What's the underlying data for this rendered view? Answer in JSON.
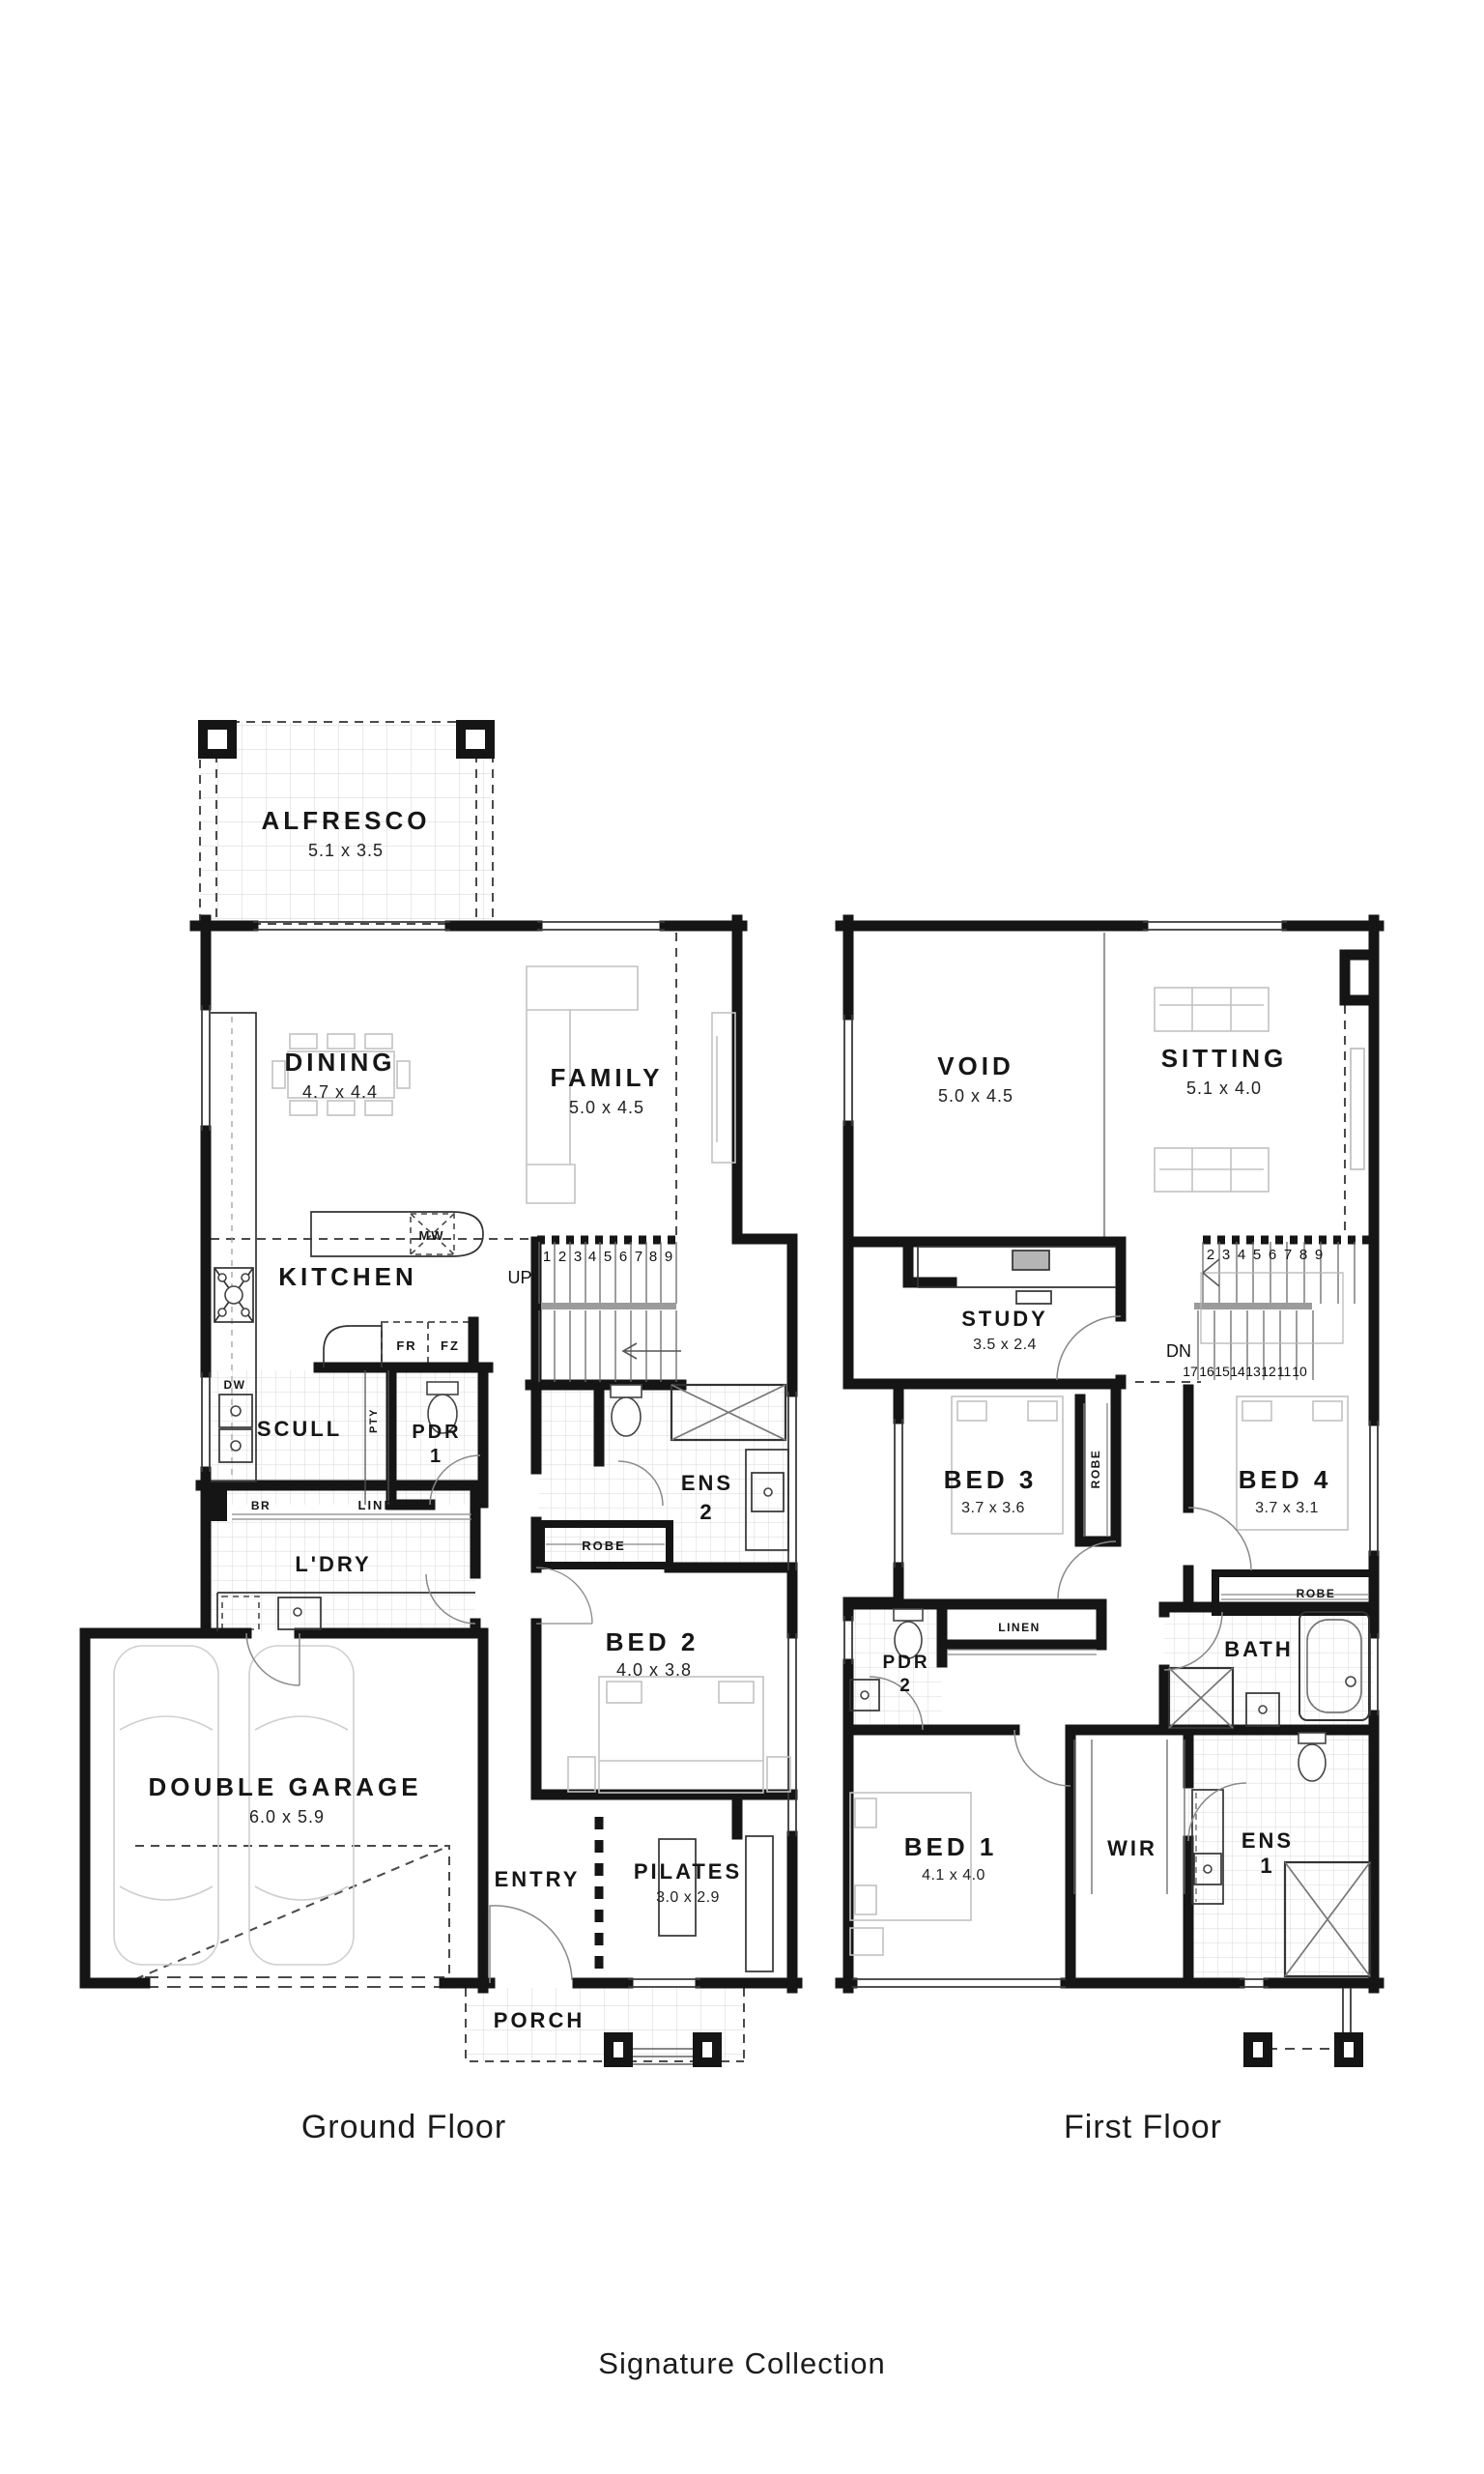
{
  "ground": {
    "caption": "Ground Floor",
    "rooms": {
      "alfresco": {
        "name": "ALFRESCO",
        "dims": "5.1 x 3.5"
      },
      "dining": {
        "name": "DINING",
        "dims": "4.7 x 4.4"
      },
      "family": {
        "name": "FAMILY",
        "dims": "5.0 x 4.5"
      },
      "kitchen": {
        "name": "KITCHEN"
      },
      "scull": {
        "name": "SCULL"
      },
      "pdr1": {
        "name": "PDR",
        "number": "1"
      },
      "ens2": {
        "name": "ENS",
        "number": "2"
      },
      "bed2": {
        "name": "BED 2",
        "dims": "4.0 x 3.8"
      },
      "ldry": {
        "name": "L'DRY"
      },
      "garage": {
        "name": "DOUBLE GARAGE",
        "dims": "6.0 x 5.9"
      },
      "entry": {
        "name": "ENTRY"
      },
      "pilates": {
        "name": "PILATES",
        "dims": "3.0 x 2.9"
      },
      "porch": {
        "name": "PORCH"
      }
    },
    "fixtures": {
      "mw": "MW",
      "fr": "FR",
      "fz": "FZ",
      "dw": "DW",
      "br": "BR",
      "pty": "PTY",
      "linen": "LINEN",
      "robe": "ROBE"
    },
    "stairs": {
      "direction": "UP",
      "numbers": [
        "1",
        "2",
        "3",
        "4",
        "5",
        "6",
        "7",
        "8",
        "9"
      ]
    }
  },
  "first": {
    "caption": "First Floor",
    "rooms": {
      "void": {
        "name": "VOID",
        "dims": "5.0 x 4.5"
      },
      "sitting": {
        "name": "SITTING",
        "dims": "5.1 x 4.0"
      },
      "study": {
        "name": "STUDY",
        "dims": "3.5 x 2.4"
      },
      "bed3": {
        "name": "BED 3",
        "dims": "3.7 x 3.6"
      },
      "bed4": {
        "name": "BED 4",
        "dims": "3.7 x 3.1"
      },
      "pdr2": {
        "name": "PDR",
        "number": "2"
      },
      "bath": {
        "name": "BATH"
      },
      "bed1": {
        "name": "BED 1",
        "dims": "4.1 x 4.0"
      },
      "wir": {
        "name": "WIR"
      },
      "ens1": {
        "name": "ENS",
        "number": "1"
      }
    },
    "fixtures": {
      "linen": "LINEN",
      "robe3": "ROBE",
      "robe4": "ROBE"
    },
    "stairs": {
      "direction": "DN",
      "upper": [
        "2",
        "3",
        "4",
        "5",
        "6",
        "7",
        "8",
        "9"
      ],
      "lower": [
        "17",
        "16",
        "15",
        "14",
        "13",
        "12",
        "11",
        "10"
      ]
    }
  },
  "footer": {
    "collection": "Signature Collection"
  }
}
